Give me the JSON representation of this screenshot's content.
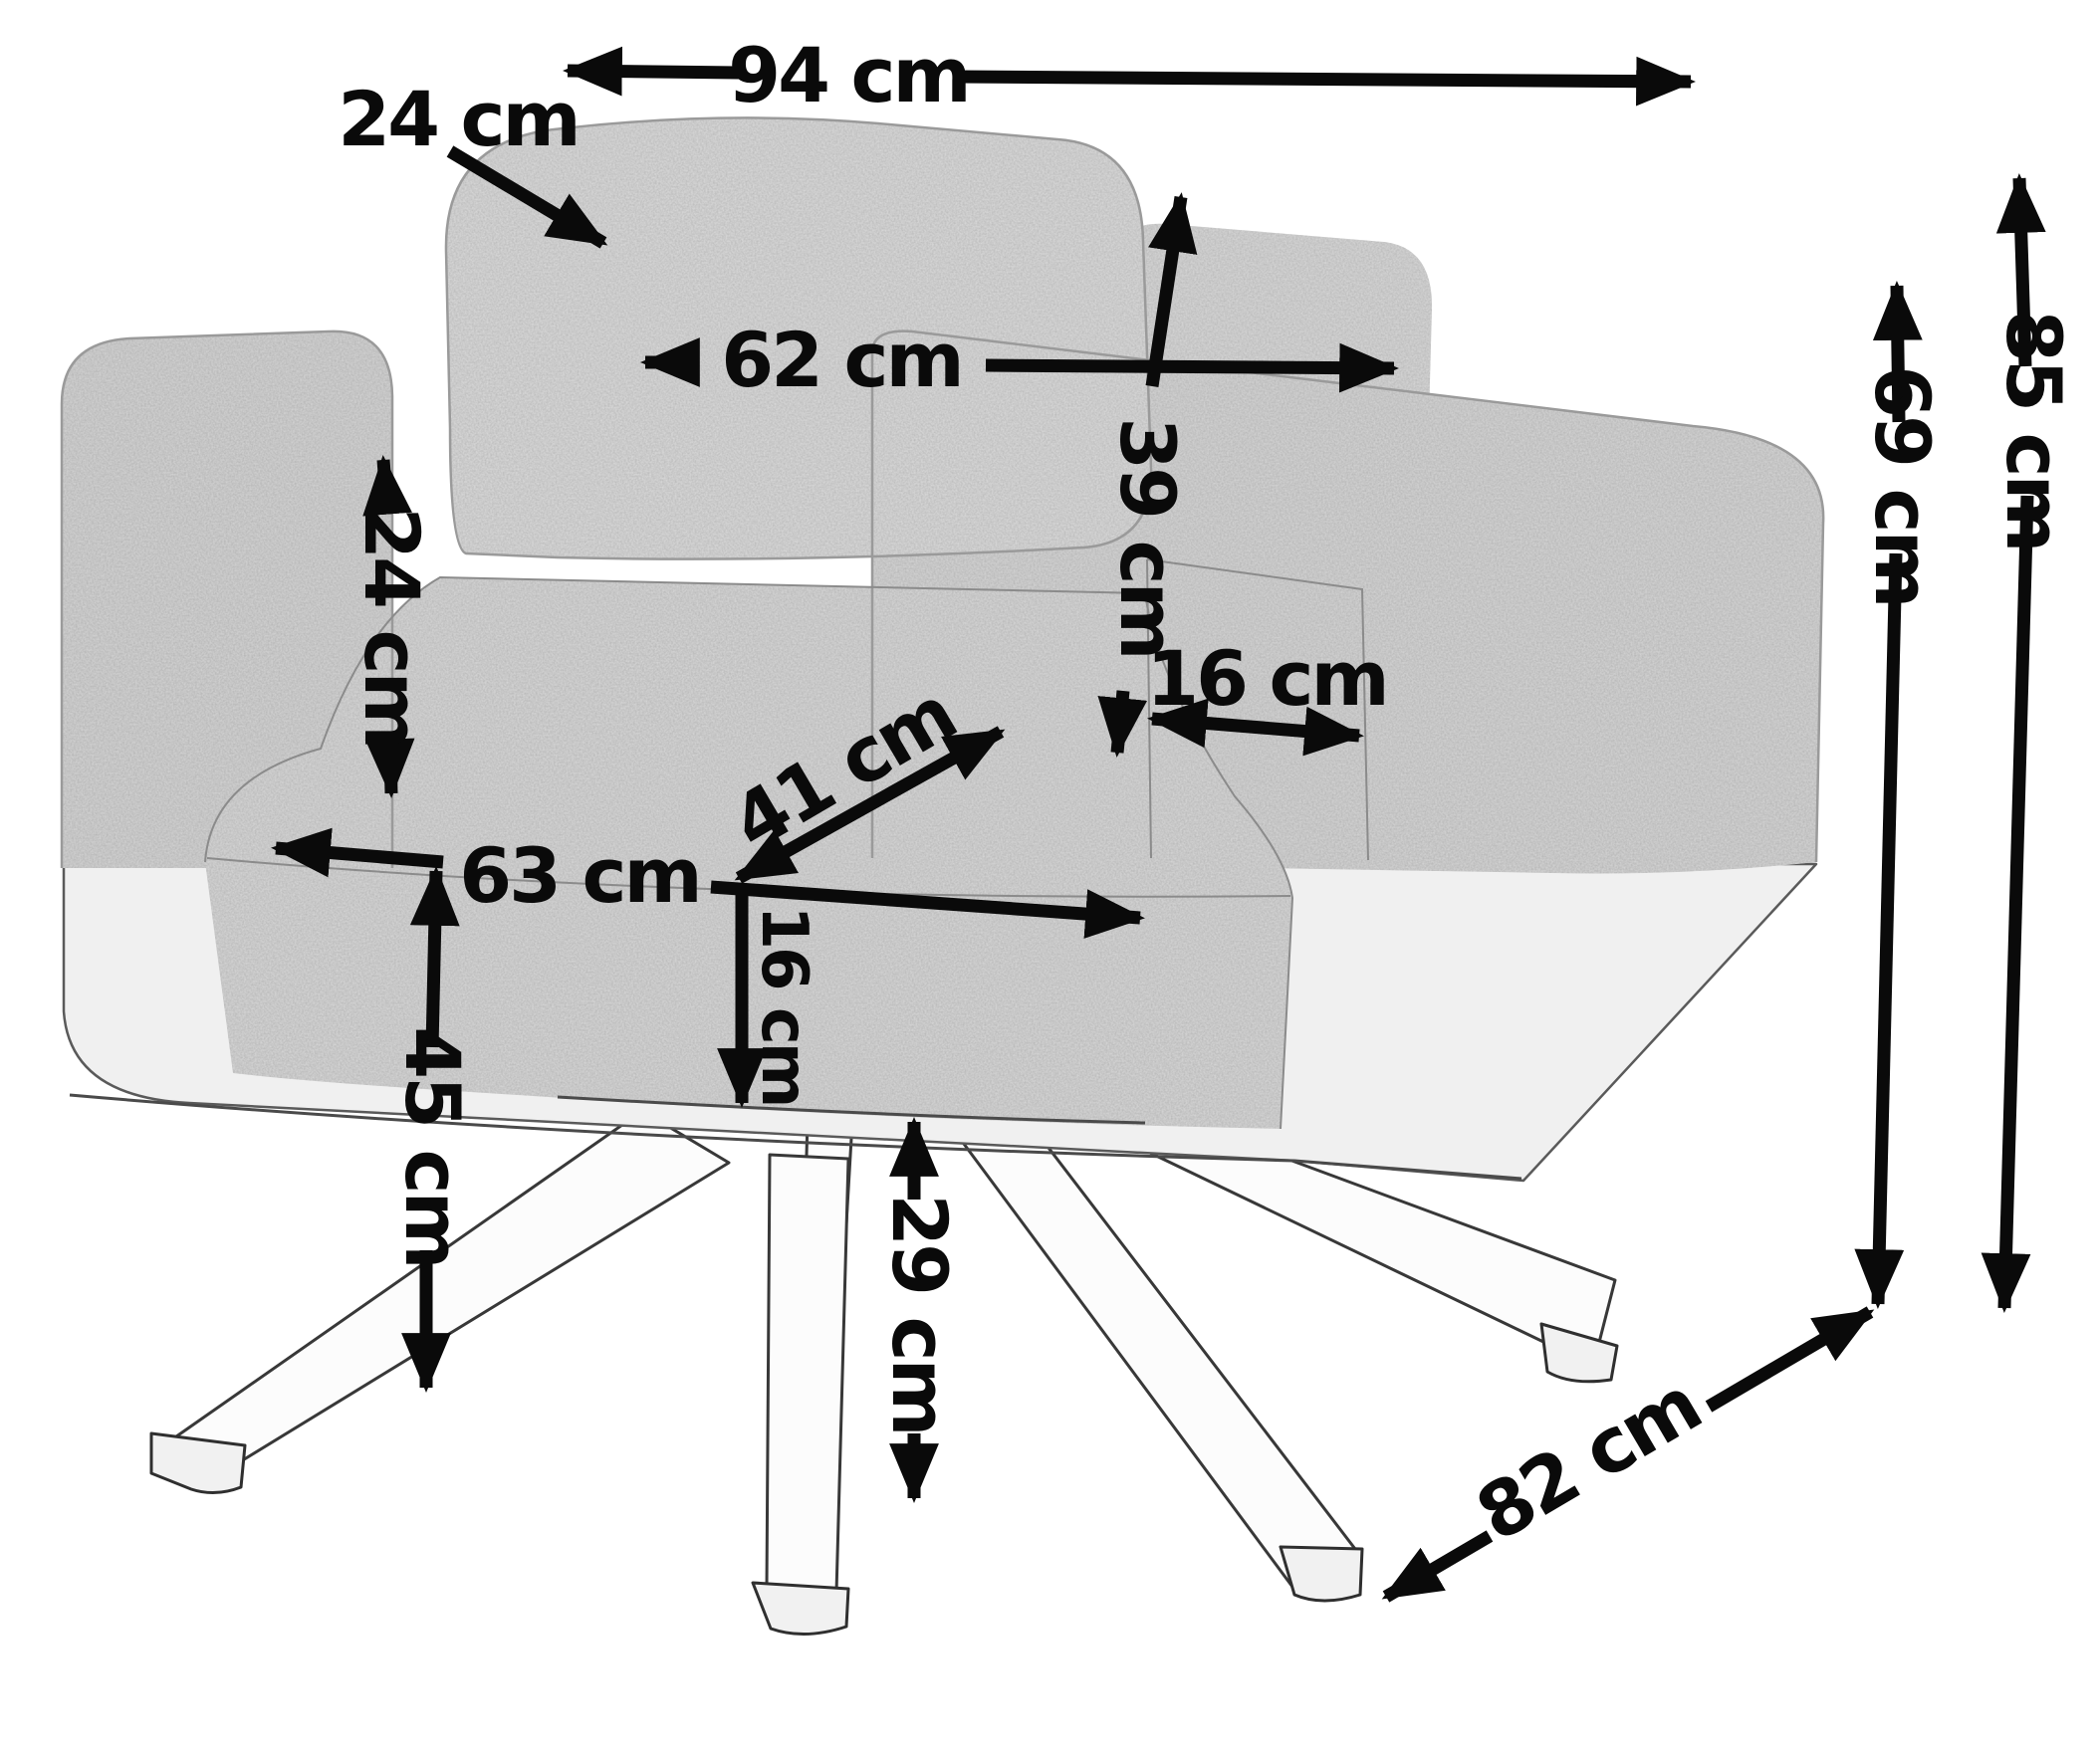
{
  "figure": {
    "type": "furniture-dimension-diagram",
    "subject": "armchair pencil sketch with swivel star base",
    "unit": "cm"
  },
  "dimensions": {
    "back_cushion_thickness": {
      "label": "24 cm",
      "value": 24
    },
    "overall_width": {
      "label": "94 cm",
      "value": 94
    },
    "back_cushion_width": {
      "label": "62 cm",
      "value": 62
    },
    "back_cushion_height": {
      "label": "39 cm",
      "value": 39
    },
    "armrest_height_above_seat": {
      "label": "24 cm",
      "value": 24
    },
    "armrest_width": {
      "label": "16 cm",
      "value": 16
    },
    "seat_width": {
      "label": "63 cm",
      "value": 63
    },
    "seat_depth": {
      "label": "41 cm",
      "value": 41
    },
    "seat_cushion_thickness": {
      "label": "16 cm",
      "value": 16
    },
    "seat_height": {
      "label": "45 cm",
      "value": 45
    },
    "base_clearance_height": {
      "label": "29 cm",
      "value": 29
    },
    "armrest_total_height": {
      "label": "69 cm",
      "value": 69
    },
    "overall_height": {
      "label": "85 cm",
      "value": 85
    },
    "overall_depth": {
      "label": "82 cm",
      "value": 82
    }
  },
  "colors": {
    "ink": "#0a0a0a",
    "fabric": "#d9d9d9",
    "background": "#ffffff"
  }
}
